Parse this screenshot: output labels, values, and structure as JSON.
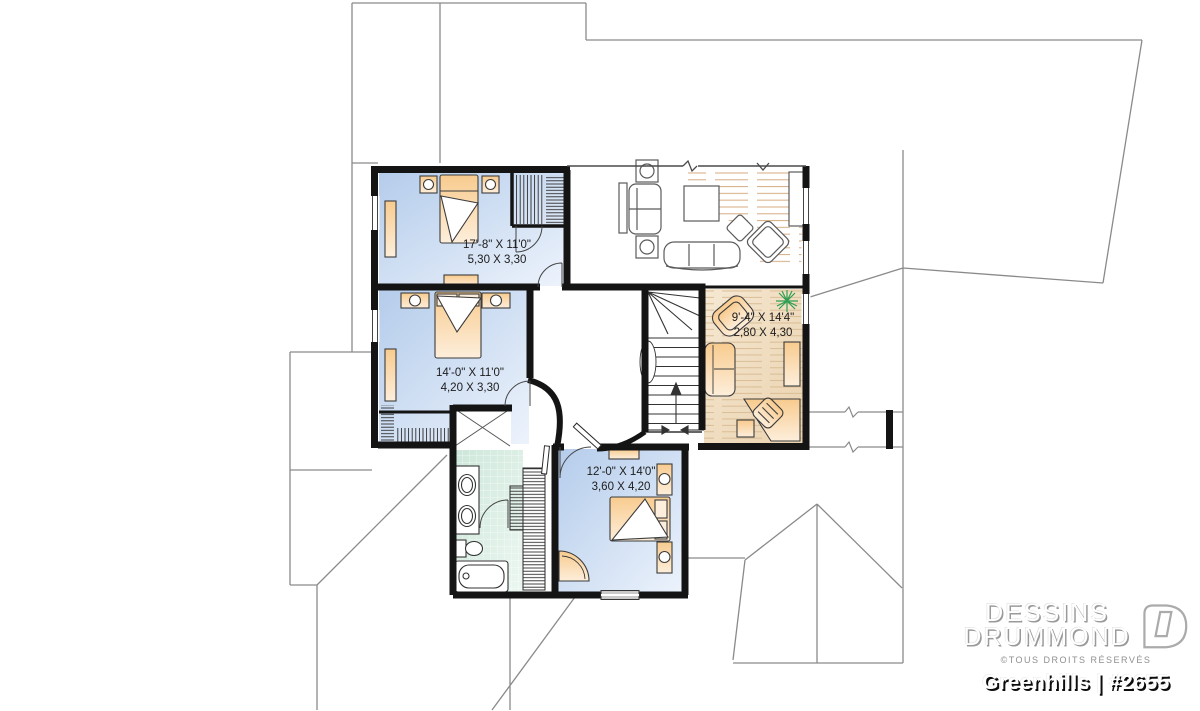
{
  "branding": {
    "brand_line1": "DESSINS",
    "brand_line2": "DRUMMOND",
    "rights_notice": "©TOUS DROITS RÉSERVÉS",
    "plan_title": "Greenhills | #2655"
  },
  "rooms": {
    "bedroom_top_left": {
      "dim_imperial": "17'-8\" X 11'0\"",
      "dim_metric": "5,30 X 3,30"
    },
    "bedroom_mid_left": {
      "dim_imperial": "14'-0\" X 11'0\"",
      "dim_metric": "4,20 X 3,30"
    },
    "sitting_room_right": {
      "dim_imperial": "9'-4\" X 14'4\"",
      "dim_metric": "2,80 X 4,30"
    },
    "bedroom_bottom": {
      "dim_imperial": "12'-0\" X 14'0\"",
      "dim_metric": "3,60 X 4,20"
    }
  },
  "colors": {
    "bedroom_floor": "#c3d4ed",
    "sitting_room_floor": "#f0ddc0",
    "bathroom_tile": "#d7ebe0",
    "furniture_fill": "#f8cf97",
    "wall": "#141414",
    "roof_line": "#8a8a8a",
    "plant": "#2f9e52"
  }
}
